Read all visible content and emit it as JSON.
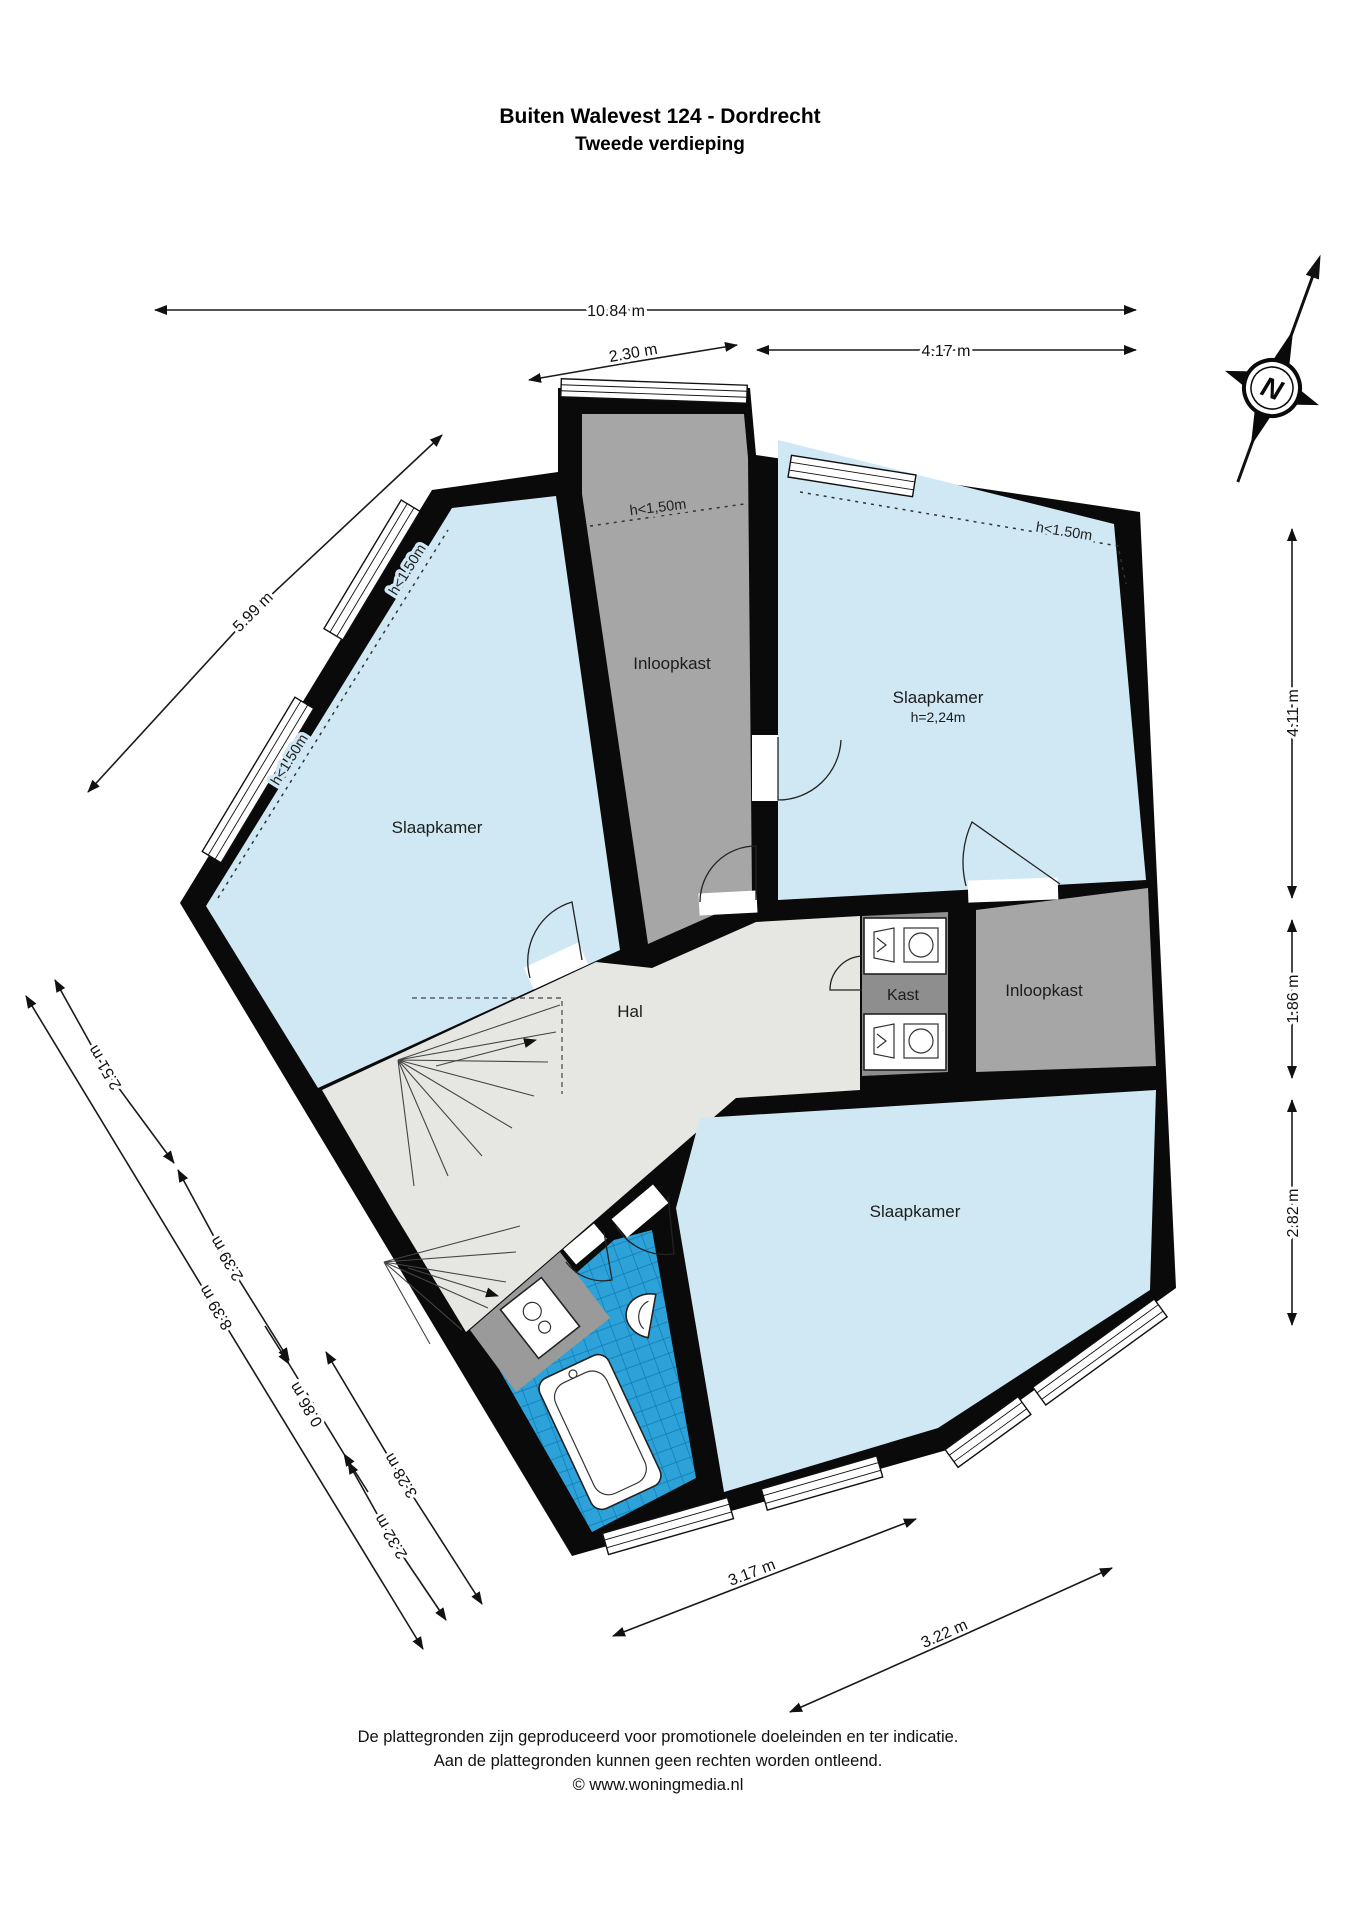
{
  "title": {
    "line1": "Buiten Walevest 124 - Dordrecht",
    "line2": "Tweede verdieping"
  },
  "compass": {
    "north": "N"
  },
  "rooms": {
    "slaapkamer_left": "Slaapkamer",
    "slaapkamer_top_right": "Slaapkamer",
    "slaapkamer_top_right_height": "h=2,24m",
    "slaapkamer_bottom_right": "Slaapkamer",
    "inloopkast_top": "Inloopkast",
    "inloopkast_right": "Inloopkast",
    "hal": "Hal",
    "kast": "Kast"
  },
  "height_markers": {
    "top_center": "h<1,50m",
    "top_right": "h<1.50m",
    "left_upper": "h<1.50m",
    "left_lower": "h<1.50m"
  },
  "dimensions": {
    "total_width": "10.84 m",
    "top_left_width": "2.30 m",
    "top_right_width": "4.17 m",
    "upper_left_wall": "5.99 m",
    "right_upper": "4.11 m",
    "right_middle": "1.86 m",
    "right_lower": "2.82 m",
    "lower_left_total": "8.39 m",
    "lower_left_1": "2.51 m",
    "lower_left_2": "2.39 m",
    "lower_left_3": "0.86 m",
    "lower_left_4": "2.32 m",
    "lower_left_inner": "3.28 m",
    "bottom_left": "3.17 m",
    "bottom_right": "3.22 m"
  },
  "footer": {
    "line1": "De plattegronden zijn geproduceerd voor promotionele doeleinden en ter indicatie.",
    "line2": "Aan de plattegronden kunnen geen rechten worden ontleend.",
    "line3": "© www.woningmedia.nl"
  },
  "colors": {
    "room_blue": "#cfe8f4",
    "tile_blue": "#2da2d8",
    "closet_gray": "#a6a6a6",
    "hall_gray": "#e6e6e3",
    "wall_black": "#0a0a0a"
  }
}
